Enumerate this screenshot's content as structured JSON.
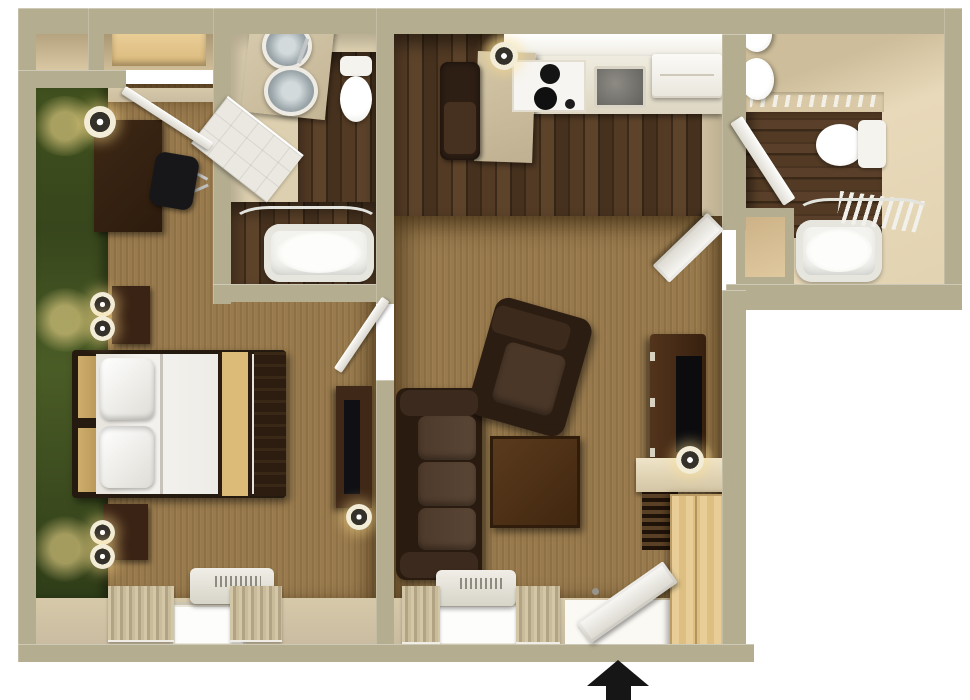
{
  "figure": {
    "type": "floor-plan-3d-render",
    "description": "Top-down 3D rendering of a one-bedroom extended-stay suite; no text labels are rendered in the image",
    "entry_indicator": "black-arrow-up"
  },
  "palette": {
    "background": "#ffffff",
    "wall": "#b4ad90",
    "interior_wall_face": "#d8cbaa",
    "accent_wall_green": "#44511f",
    "carpet_tan": "#997a4c",
    "dark_wood_floor": "#4c3520",
    "light_wood": "#e3c68e",
    "furniture_dark_brown": "#382413",
    "fixture_white": "#f3f3ef",
    "bed_runner_tan": "#d9b876",
    "counter_beige": "#cbbd9e",
    "arrow_black": "#161616"
  },
  "rooms": {
    "bedroom": {
      "label": "Bedroom",
      "furniture": [
        "closet",
        "closet-dresser",
        "desk-dresser",
        "desk-chair",
        "desk-lamp",
        "queen-bed",
        "headboard",
        "nightstand-north",
        "nightstand-south",
        "nightstand-lamps",
        "tv-dresser",
        "television",
        "ptac-ac-unit",
        "window-with-curtains",
        "green-accent-wall"
      ]
    },
    "bathroom_master": {
      "label": "Master Bathroom",
      "furniture": [
        "double-vessel-sink-vanity",
        "toilet",
        "shower-door-panel",
        "bathtub",
        "curved-shower-rod"
      ]
    },
    "kitchen": {
      "label": "Kitchen",
      "furniture": [
        "dining-chair",
        "counter-island",
        "pendant-light",
        "upper-cabinets",
        "range-cooktop",
        "kitchen-sink",
        "refrigerator"
      ]
    },
    "living_room": {
      "label": "Living Room",
      "furniture": [
        "sofa",
        "armchair",
        "coffee-table",
        "media-console",
        "television",
        "table-lamp",
        "side-counter",
        "louvered-shelf",
        "wardrobe-cabinet",
        "ptac-ac-unit",
        "window-with-curtains",
        "entry-door"
      ]
    },
    "bathroom_second": {
      "label": "Second Bathroom",
      "furniture": [
        "wall-sinks",
        "toilet",
        "shower-door-panel",
        "bathtub",
        "curved-shower-rod",
        "towel-rack",
        "linen-closet",
        "entry-door"
      ]
    }
  },
  "arrow": {
    "meaning": "unit entrance",
    "direction": "up",
    "color": "#161616"
  }
}
